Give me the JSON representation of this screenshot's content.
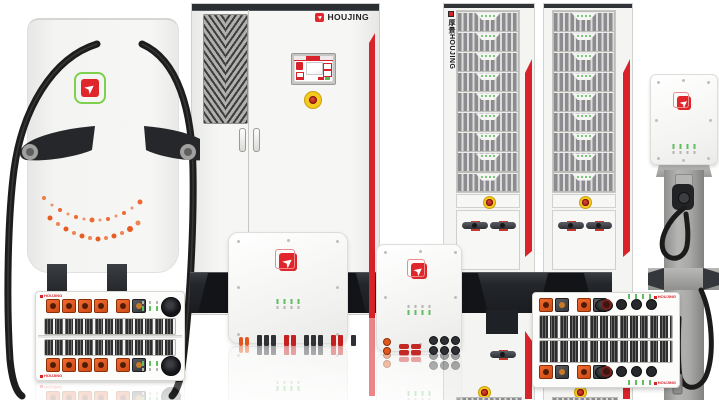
{
  "brand": {
    "logo_text": "HOUJING",
    "logo_text_small": "HOUJING",
    "vertical_logo_text": "厚景HOUJING"
  },
  "colors": {
    "accent_red": "#d8232a",
    "connector_orange": "#e2571f",
    "led_green": "#6abf69",
    "estop_ring_yellow": "#f2c01d",
    "estop_core_red": "#c62f28",
    "cabinet_body": "#f3f3f1",
    "dark_base": "#22252a",
    "cable_black": "#1d1d1d",
    "pedestal_gray": "#a2a2a0",
    "logo_green_outline": "#7ed04d"
  }
}
